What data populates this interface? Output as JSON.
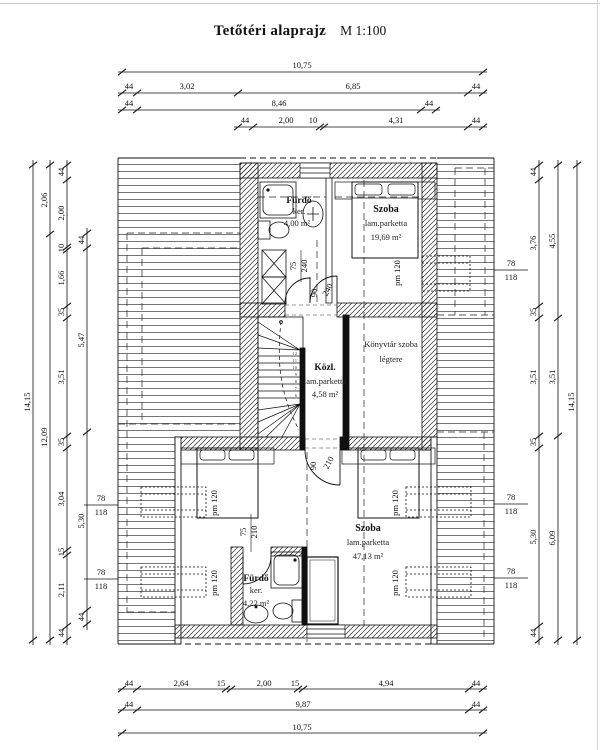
{
  "title": {
    "text": "Tetőtéri alaprajz",
    "scale": "M 1:100"
  },
  "rooms": {
    "bath_upper": {
      "name": "Fürdő",
      "finish": "ker.",
      "area": "4,00 m²"
    },
    "room_upper": {
      "name": "Szoba",
      "finish": "lam.parketta",
      "area": "19,69 m²"
    },
    "hall": {
      "name": "Közl.",
      "finish": "lam.parketta",
      "area": "4,58 m²"
    },
    "library": {
      "line1": "Könyvtár szoba",
      "line2": "légtere"
    },
    "room_lower": {
      "name": "Szoba",
      "finish": "lam.parketta",
      "area": "47,13 m²"
    },
    "bath_lower": {
      "name": "Fürdő",
      "finish": "ker.",
      "area": "4,22 m²"
    }
  },
  "doors": {
    "d1": [
      "75",
      "240"
    ],
    "d2": [
      "90",
      "240"
    ],
    "d3": [
      "90",
      "210"
    ],
    "d4": [
      "75",
      "210"
    ]
  },
  "windows": {
    "parapet": "pm 120",
    "num": "78",
    "den": "118"
  },
  "stair": {
    "steps": [
      "12",
      "11",
      "10",
      "9",
      "8",
      "7",
      "6"
    ]
  },
  "dims": {
    "t1": [
      "10,75"
    ],
    "t2": [
      "44",
      "3,02",
      "6,85",
      "44"
    ],
    "t3": [
      "44",
      "8,46",
      "44"
    ],
    "t4": [
      "44",
      "2,00",
      "10",
      "4,31",
      "44"
    ],
    "b1": [
      "44",
      "2,64",
      "15",
      "2,00",
      "15",
      "4,94",
      "44"
    ],
    "b2": [
      "44",
      "9,87",
      "44"
    ],
    "b3": [
      "10,75"
    ],
    "l1": [
      "14,15"
    ],
    "l2": [
      "2,06",
      "12,09"
    ],
    "l3": [
      "44",
      "2,00",
      "10",
      "1,66",
      "35",
      "3,51",
      "35",
      "3,04",
      "15",
      "2,11",
      "44"
    ],
    "l4": [
      "44",
      "5,47",
      "5,30",
      "44"
    ],
    "r1": [
      "44",
      "3,76",
      "35",
      "3,51",
      "35",
      "5,30",
      "44"
    ],
    "r2": [
      "4,55",
      "3,51",
      "6,09"
    ],
    "r3": [
      "14,15"
    ]
  }
}
